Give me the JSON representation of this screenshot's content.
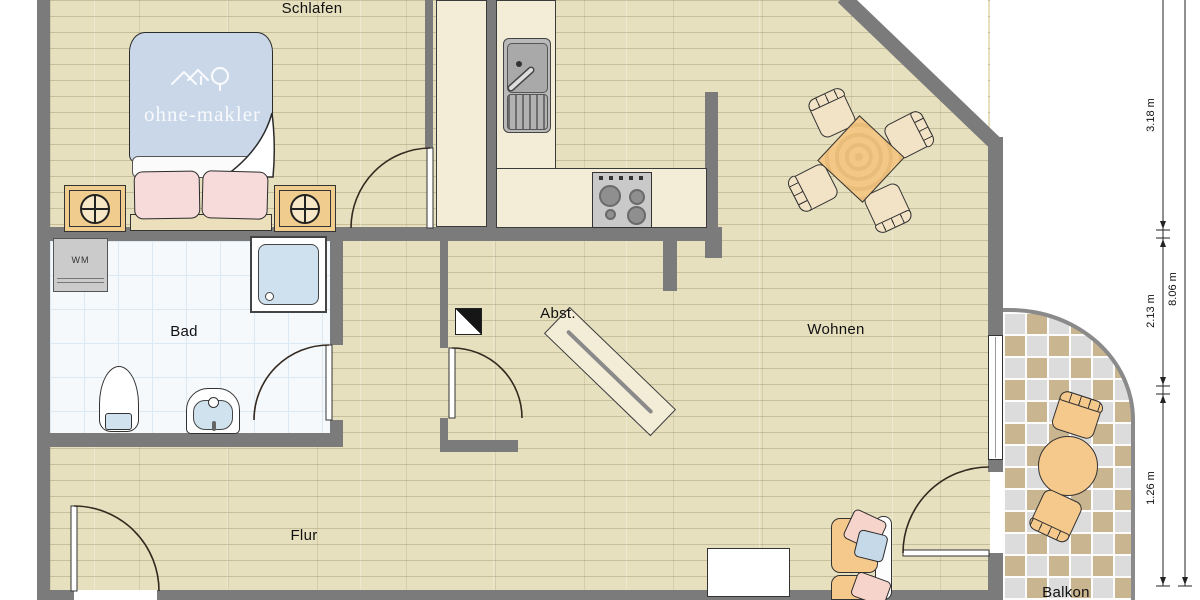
{
  "rooms": {
    "schlafen": "Schlafen",
    "bad": "Bad",
    "abst": "Abst.",
    "wohnen": "Wohnen",
    "flur": "Flur",
    "balkon": "Balkon"
  },
  "labels": {
    "washing_machine": "WM"
  },
  "watermark": {
    "text": "ohne-makler"
  },
  "dimensions": {
    "segments": [
      {
        "label": "3.18 m"
      },
      {
        "label": "2.13 m"
      },
      {
        "label": "1.26 m"
      }
    ],
    "total": {
      "label": "8.06 m"
    }
  },
  "colors": {
    "wall": "#7b7b7b",
    "wood_floor": "#e6e0bf",
    "bath_tile": "#f6f9fc",
    "balcony_tile_tan": "#c9b58f",
    "balcony_tile_gray": "#dcdcdc",
    "counter_cream": "#f3ecd7",
    "furniture_orange": "#f5c88c",
    "duvet_blue": "#c9d7e8",
    "pillow_pink": "#f7dada"
  }
}
